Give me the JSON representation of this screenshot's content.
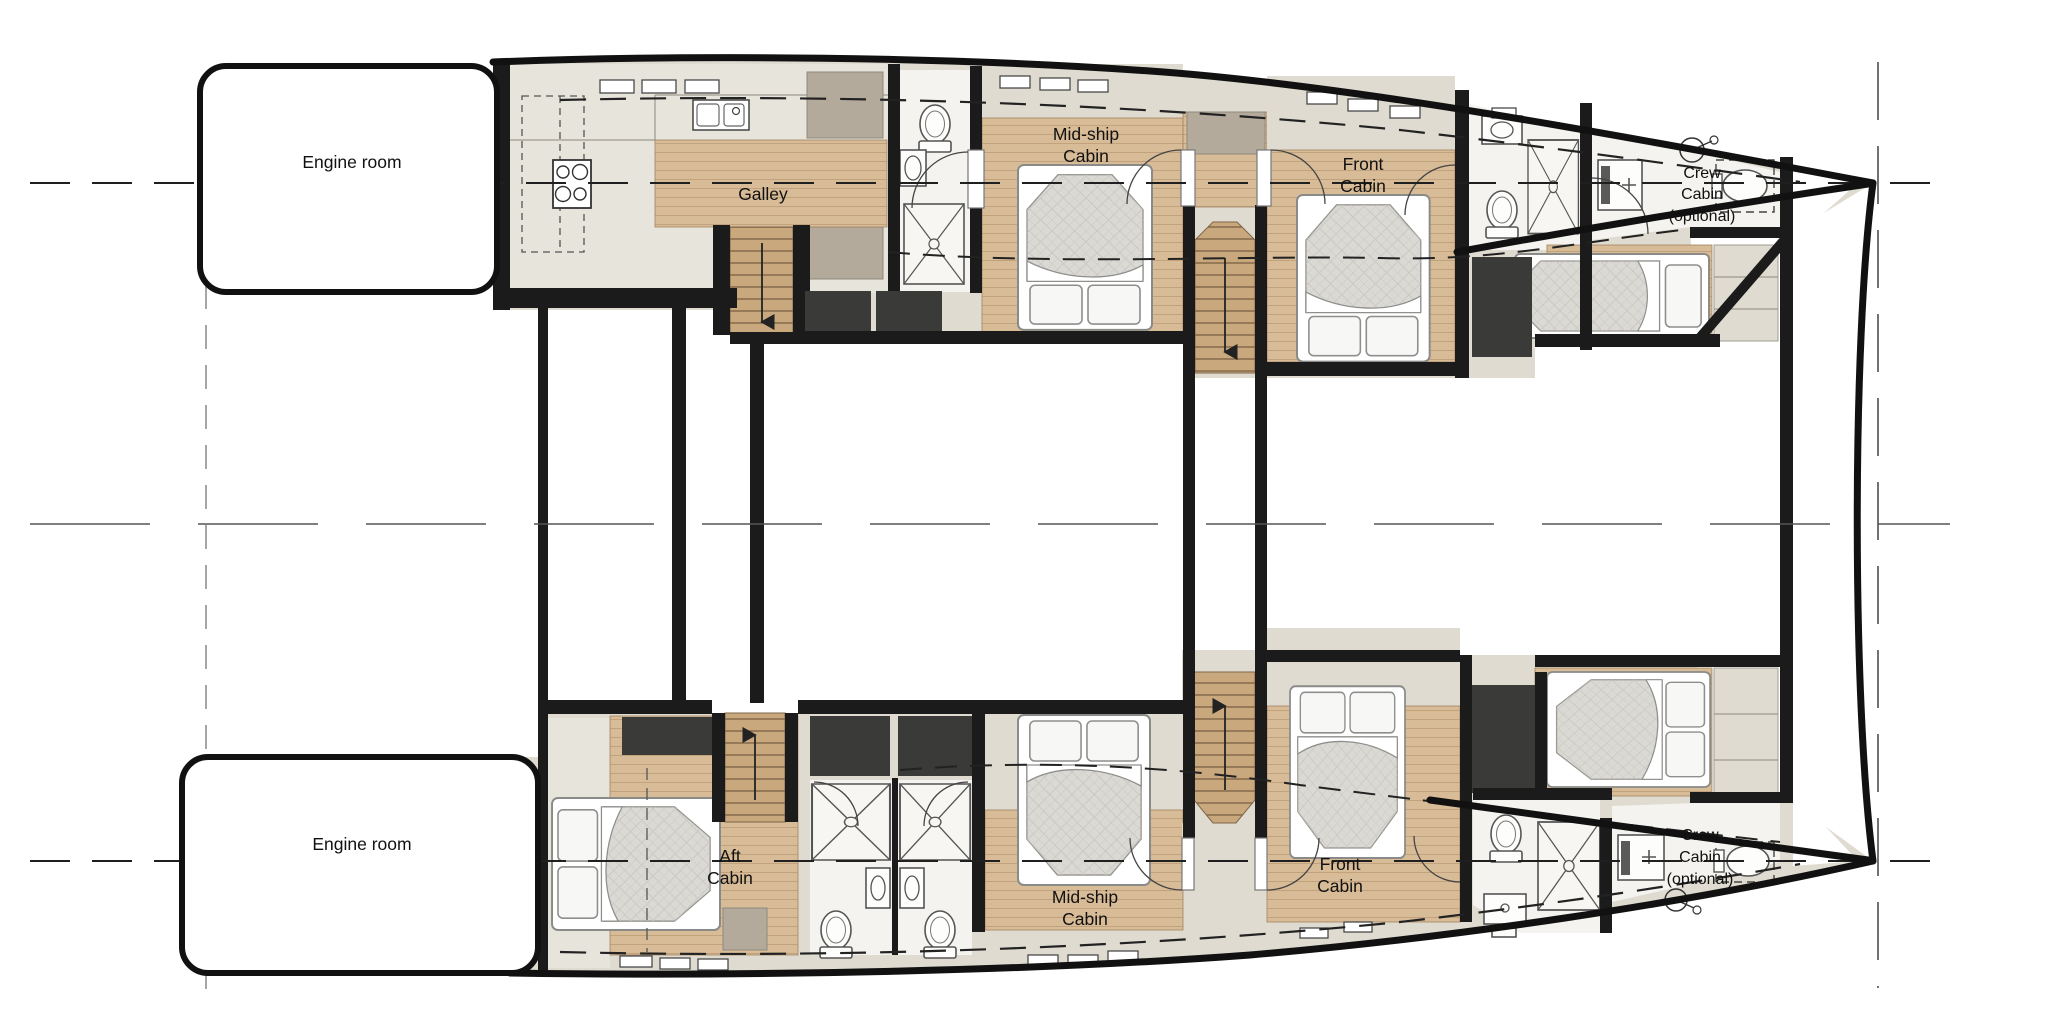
{
  "figure": {
    "type": "yacht-deck-floor-plan",
    "description": "Catamaran lower deck layout, two hulls with cabins",
    "colors": {
      "wall": "#1b1b1b",
      "floor_wood": "#d8bb97",
      "floor_beige": "#dfdbd0",
      "floor_gray": "#e7e4db",
      "room_white": "#f4f3ef",
      "void_charcoal": "#3a3a38",
      "cabinet_tan": "#b3aa9b"
    },
    "icons": [
      "stove-icon",
      "sink-icon",
      "toilet-icon",
      "shower-icon",
      "washbasin-icon",
      "ceiling-light-icon",
      "stairs-down-icon",
      "stairs-up-icon",
      "window",
      "door-arc",
      "double-bed",
      "single-bed"
    ],
    "labels": {
      "engine_room_top": "Engine room",
      "engine_room_bottom": "Engine room",
      "galley": "Galley",
      "midship_cabin_top": {
        "line1": "Mid-ship",
        "line2": "Cabin"
      },
      "midship_cabin_bottom": {
        "line1": "Mid-ship",
        "line2": "Cabin"
      },
      "front_cabin_top": {
        "line1": "Front",
        "line2": "Cabin"
      },
      "front_cabin_bottom": {
        "line1": "Front",
        "line2": "Cabin"
      },
      "aft_cabin": {
        "line1": "Aft",
        "line2": "Cabin"
      },
      "crew_cabin_top": {
        "line1": "Crew",
        "line2": "Cabin",
        "line3": "(optional)"
      },
      "crew_cabin_bottom": {
        "line1": "Crew",
        "line2": "Cabin",
        "line3": "(optional)"
      }
    }
  }
}
